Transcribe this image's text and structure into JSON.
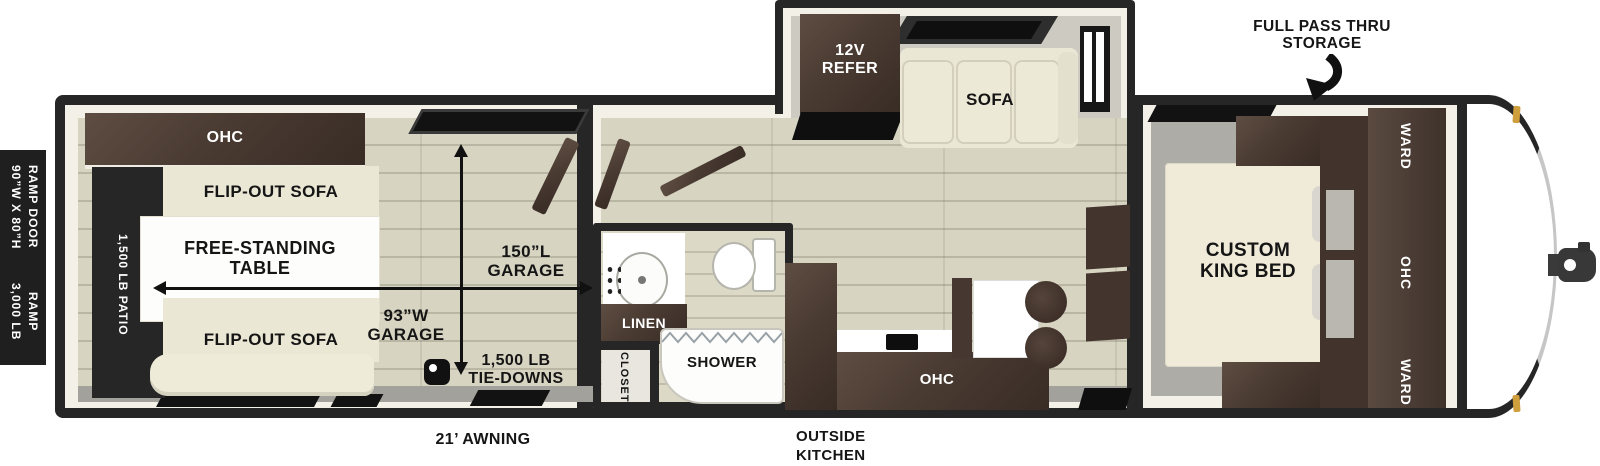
{
  "colors": {
    "frame": "#262626",
    "cabinet_brown": "#4a3b32",
    "cream_furniture": "#ebe7d5",
    "wood_floor": "#d8d4c2",
    "gray_floor": "#aeaca7",
    "marker_light": "#cf9e3d",
    "label_text": "#151515",
    "label_text_inverse": "#ffffff"
  },
  "icons": {
    "tie_down": "d-ring-anchor",
    "storage_arrow": "curved-down-arrow",
    "garage_length_arrow": "vertical-double-arrow",
    "garage_width_arrow": "horizontal-double-arrow"
  },
  "ramp": {
    "size_line1": "90”W X 80”H",
    "size_line2": "RAMP DOOR",
    "weight_line1": "3,000 LB RAMP",
    "weight_line2": "DOOR"
  },
  "garage": {
    "ohc": "OHC",
    "patio": "1,500 LB PATIO",
    "flip_sofa_top": "FLIP-OUT SOFA",
    "flip_sofa_bottom": "FLIP-OUT SOFA",
    "table_line1": "FREE-STANDING",
    "table_line2": "TABLE",
    "length_line1": "150”L",
    "length_line2": "GARAGE",
    "width_line1": "93”W",
    "width_line2": "GARAGE",
    "tiedowns_line1": "1,500 LB",
    "tiedowns_line2": "TIE-DOWNS"
  },
  "bath": {
    "linen": "LINEN",
    "shower": "SHOWER",
    "closet": "CLOSET"
  },
  "slide": {
    "refer_line1": "12V",
    "refer_line2": "REFER",
    "sofa": "SOFA"
  },
  "kitchen": {
    "ohc": "OHC",
    "outside_line1": "OUTSIDE",
    "outside_line2": "KITCHEN"
  },
  "bedroom": {
    "bed_line1": "CUSTOM",
    "bed_line2": "KING BED",
    "ward_top": "WARD",
    "ohc": "OHC",
    "ward_bottom": "WARD"
  },
  "annotations": {
    "storage_line1": "FULL PASS THRU",
    "storage_line2": "STORAGE",
    "awning": "21’ AWNING"
  }
}
